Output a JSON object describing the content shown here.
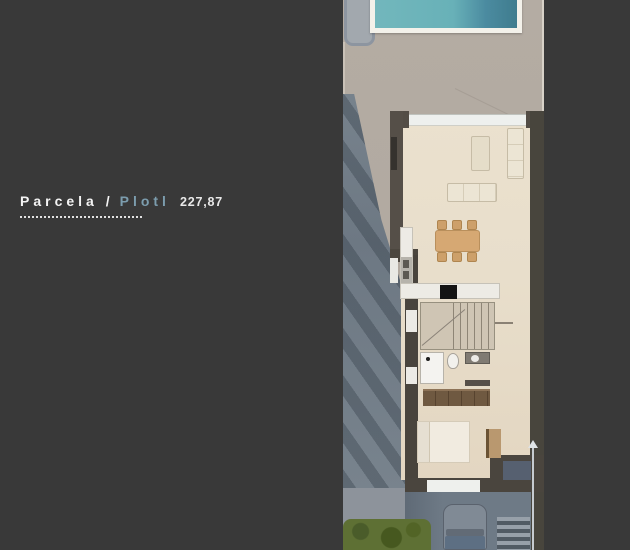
{
  "label": {
    "primary": "Parcela /",
    "secondary": "Plotl",
    "value": "227,87"
  },
  "colors": {
    "background": "#393939",
    "label_primary": "#f4f4f4",
    "label_secondary": "#7c9dae",
    "label_value": "#e9e9e9",
    "pool_water": "#68b3ba",
    "pool_water_deep": "#3f7c8e",
    "pool_deck": "#f3f1ea",
    "terrace": "#b2aaa1",
    "house_wall": "#4c473f",
    "interior_floor": "#e8decb",
    "dining_wood": "#d6a873",
    "wardrobe_wood": "#6f5941",
    "driveway": "#6e7a86",
    "garden_green": "#5e7034",
    "car_body": "#808a95"
  },
  "plan": {
    "description": "Top-down 3D render of a narrow residential plot: pool terrace at top, house floor plan in the middle, driveway with parked car and garden at the bottom",
    "rooms": [
      "pool terrace",
      "swimming pool",
      "living room",
      "dining area",
      "kitchen",
      "staircase",
      "bathroom",
      "wardrobe",
      "bedroom",
      "driveway",
      "garden"
    ]
  }
}
